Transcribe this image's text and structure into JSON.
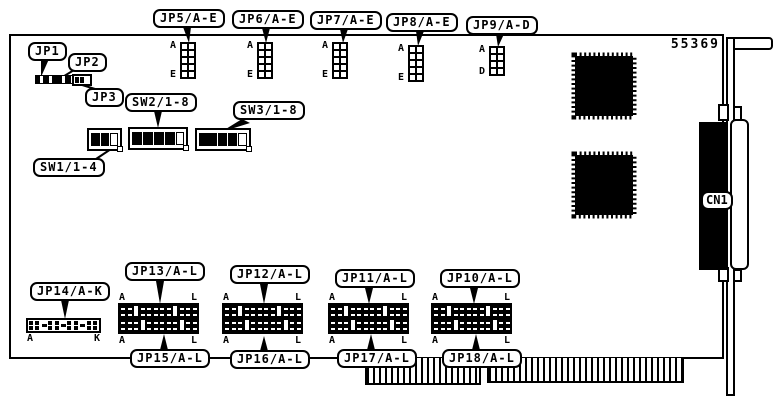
{
  "figure": {
    "part_number": "55369"
  },
  "colors": {
    "ink": "#000000",
    "paper": "#ffffff"
  },
  "top_jumpers": [
    {
      "id": "jp5",
      "label": "JP5/A-E",
      "first_pin": "A",
      "last_pin": "E",
      "pin_rows": 5
    },
    {
      "id": "jp6",
      "label": "JP6/A-E",
      "first_pin": "A",
      "last_pin": "E",
      "pin_rows": 5
    },
    {
      "id": "jp7",
      "label": "JP7/A-E",
      "first_pin": "A",
      "last_pin": "E",
      "pin_rows": 5
    },
    {
      "id": "jp8",
      "label": "JP8/A-E",
      "first_pin": "A",
      "last_pin": "E",
      "pin_rows": 5
    },
    {
      "id": "jp9",
      "label": "JP9/A-D",
      "first_pin": "A",
      "last_pin": "D",
      "pin_rows": 4
    }
  ],
  "small_jumpers": [
    {
      "id": "jp1",
      "label": "JP1"
    },
    {
      "id": "jp2",
      "label": "JP2"
    },
    {
      "id": "jp3",
      "label": "JP3"
    }
  ],
  "dip_switches": [
    {
      "id": "sw1",
      "label": "SW1/1-4"
    },
    {
      "id": "sw2",
      "label": "SW2/1-8"
    },
    {
      "id": "sw3",
      "label": "SW3/1-8"
    }
  ],
  "bottom_jumpers": [
    {
      "id": "jp13",
      "label": "JP13/A-L",
      "pair_id": "jp15",
      "pair_label": "JP15/A-L",
      "corners": {
        "tl": "A",
        "tr": "L",
        "bl": "A",
        "br": "L"
      }
    },
    {
      "id": "jp12",
      "label": "JP12/A-L",
      "pair_id": "jp16",
      "pair_label": "JP16/A-L",
      "corners": {
        "tl": "A",
        "tr": "L",
        "bl": "A",
        "br": "L"
      }
    },
    {
      "id": "jp11",
      "label": "JP11/A-L",
      "pair_id": "jp17",
      "pair_label": "JP17/A-L",
      "corners": {
        "tl": "A",
        "tr": "L",
        "bl": "A",
        "br": "L"
      }
    },
    {
      "id": "jp10",
      "label": "JP10/A-L",
      "pair_id": "jp18",
      "pair_label": "JP18/A-L",
      "corners": {
        "tl": "A",
        "tr": "L",
        "bl": "A",
        "br": "L"
      }
    }
  ],
  "jp14": {
    "id": "jp14",
    "label": "JP14/A-K",
    "first_pin": "A",
    "last_pin": "K"
  },
  "connector": {
    "id": "cn1",
    "label": "CN1"
  }
}
